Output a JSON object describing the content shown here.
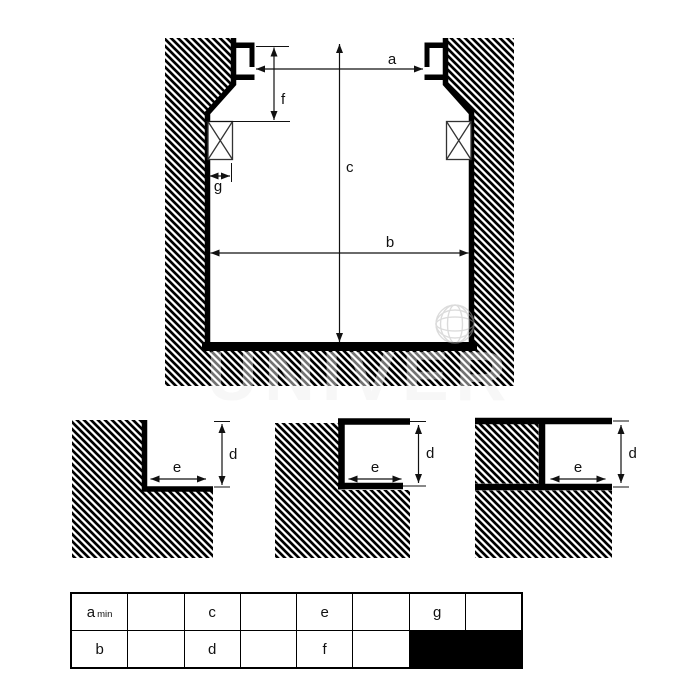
{
  "diagram": {
    "main_section": {
      "dim_a": "a",
      "dim_b": "b",
      "dim_c": "c",
      "dim_f": "f",
      "dim_g": "g"
    },
    "detail_rebate": {
      "dim_d": "d",
      "dim_e": "e"
    },
    "detail_flanged_rebate": {
      "dim_d": "d",
      "dim_e": "e"
    },
    "detail_channel": {
      "dim_d": "d",
      "dim_e": "e"
    },
    "hatch_style": "diagonal 45-deg black hatching",
    "seal_symbol": "crossed rectangle (sealing ring) on both walls"
  },
  "table": {
    "row1": {
      "col1": "a",
      "col1_sub": "min",
      "col2": "",
      "col3": "c",
      "col4": "",
      "col5": "e",
      "col6": "",
      "col7": "g",
      "col8": ""
    },
    "row2": {
      "col1": "b",
      "col2": "",
      "col3": "d",
      "col4": "",
      "col5": "f",
      "col6": ""
    },
    "filled_cell": "row2 col7-col8 solid black"
  },
  "watermark": {
    "text": "UNIVER",
    "icon": "globe"
  },
  "colors": {
    "ink": "#000000",
    "dim_label": "#111111",
    "filled_cell": "#000000",
    "watermark": "#9a9a9a"
  }
}
